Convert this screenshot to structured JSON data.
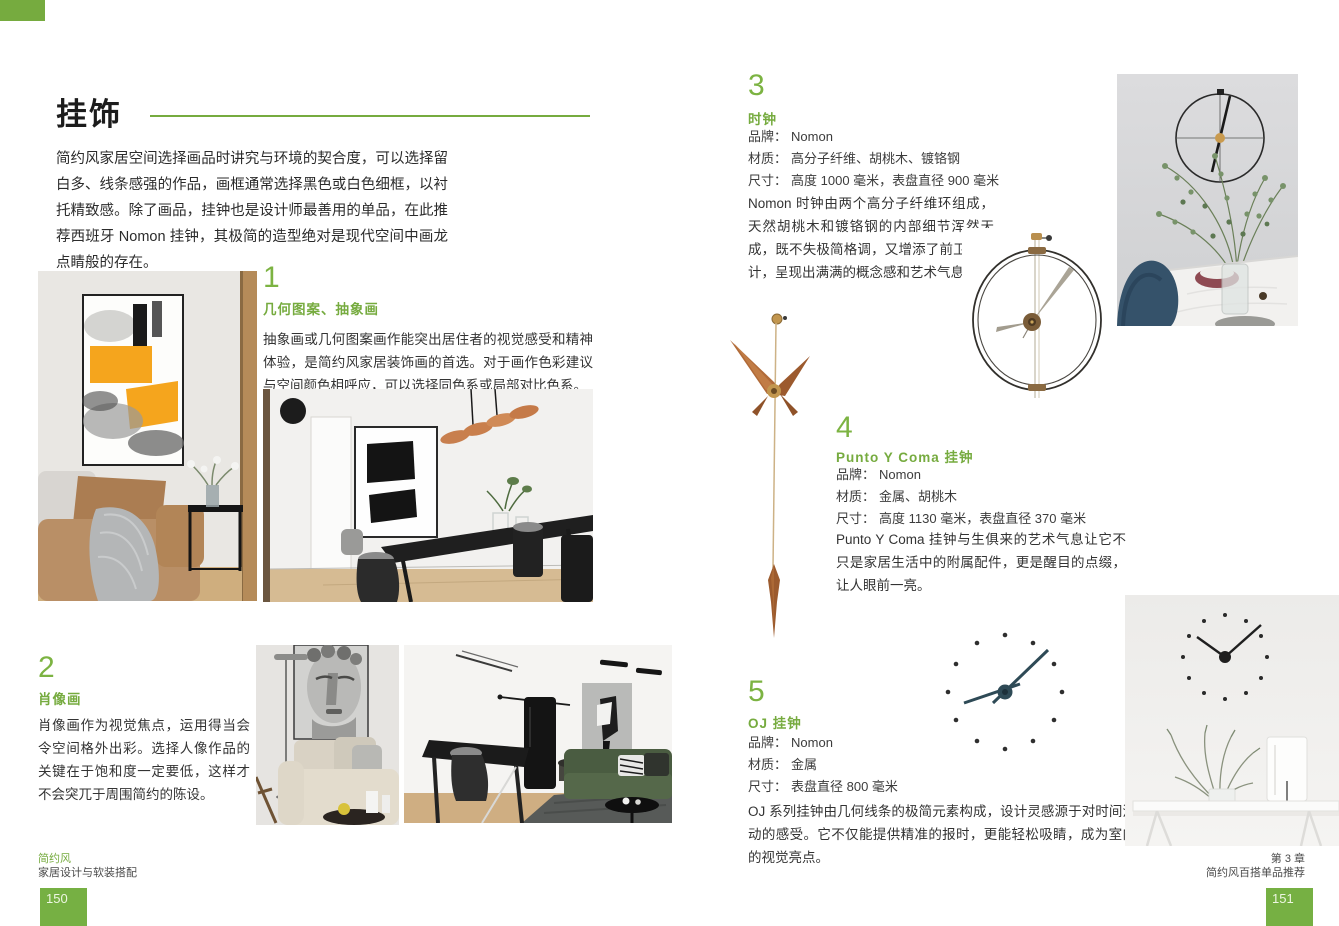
{
  "colors": {
    "accent_green": "#76ab3f",
    "page_number_bg": "#76b043"
  },
  "page_left": {
    "page_number": "150",
    "title": "挂饰",
    "intro": "简约风家居空间选择画品时讲究与环境的契合度，可以选择留白多、线条感强的作品，画框通常选择黑色或白色细框，以衬托精致感。除了画品，挂钟也是设计师最善用的单品，在此推荐西班牙 Nomon 挂钟，其极简的造型绝对是现代空间中画龙点睛般的存在。",
    "sections": [
      {
        "number": "1",
        "title": "几何图案、抽象画",
        "body": "抽象画或几何图案画作能突出居住者的视觉感受和精神体验，是简约风家居装饰画的首选。对于画作色彩建议与空间颜色相呼应，可以选择同色系或局部对比色系。"
      },
      {
        "number": "2",
        "title": "肖像画",
        "body": "肖像画作为视觉焦点，运用得当会令空间格外出彩。选择人像作品的关键在于饱和度一定要低，这样才不会突兀于周围简约的陈设。"
      }
    ],
    "footer": {
      "series": "简约风",
      "book_title": "家居设计与软装搭配"
    }
  },
  "page_right": {
    "page_number": "151",
    "sections": [
      {
        "number": "3",
        "title": "时钟",
        "specs": [
          {
            "label": "品牌：",
            "value": "Nomon"
          },
          {
            "label": "材质：",
            "value": "高分子纤维、胡桃木、镀铬钢"
          },
          {
            "label": "尺寸：",
            "value": "高度 1000 毫米，表盘直径 900 毫米"
          }
        ],
        "body": "Nomon 时钟由两个高分子纤维环组成，天然胡桃木和镀铬钢的内部细节浑然天成，既不失极简格调，又增添了前卫的设计，呈现出满满的概念感和艺术气息。"
      },
      {
        "number": "4",
        "title": "Punto Y Coma 挂钟",
        "specs": [
          {
            "label": "品牌：",
            "value": "Nomon"
          },
          {
            "label": "材质：",
            "value": "金属、胡桃木"
          },
          {
            "label": "尺寸：",
            "value": "高度 1130 毫米，表盘直径 370 毫米"
          }
        ],
        "body": "Punto Y Coma 挂钟与生俱来的艺术气息让它不只是家居生活中的附属配件，更是醒目的点缀，让人眼前一亮。"
      },
      {
        "number": "5",
        "title": "OJ 挂钟",
        "specs": [
          {
            "label": "品牌：",
            "value": "Nomon"
          },
          {
            "label": "材质：",
            "value": "金属"
          },
          {
            "label": "尺寸：",
            "value": "表盘直径 800 毫米"
          }
        ],
        "body": "OJ 系列挂钟由几何线条的极简元素构成，设计灵感源于对时间流动的感受。它不仅能提供精准的报时，更能轻松吸睛，成为室内的视觉亮点。"
      }
    ],
    "footer": {
      "chapter": "第 3 章",
      "chapter_title": "简约风百搭单品推荐"
    }
  }
}
